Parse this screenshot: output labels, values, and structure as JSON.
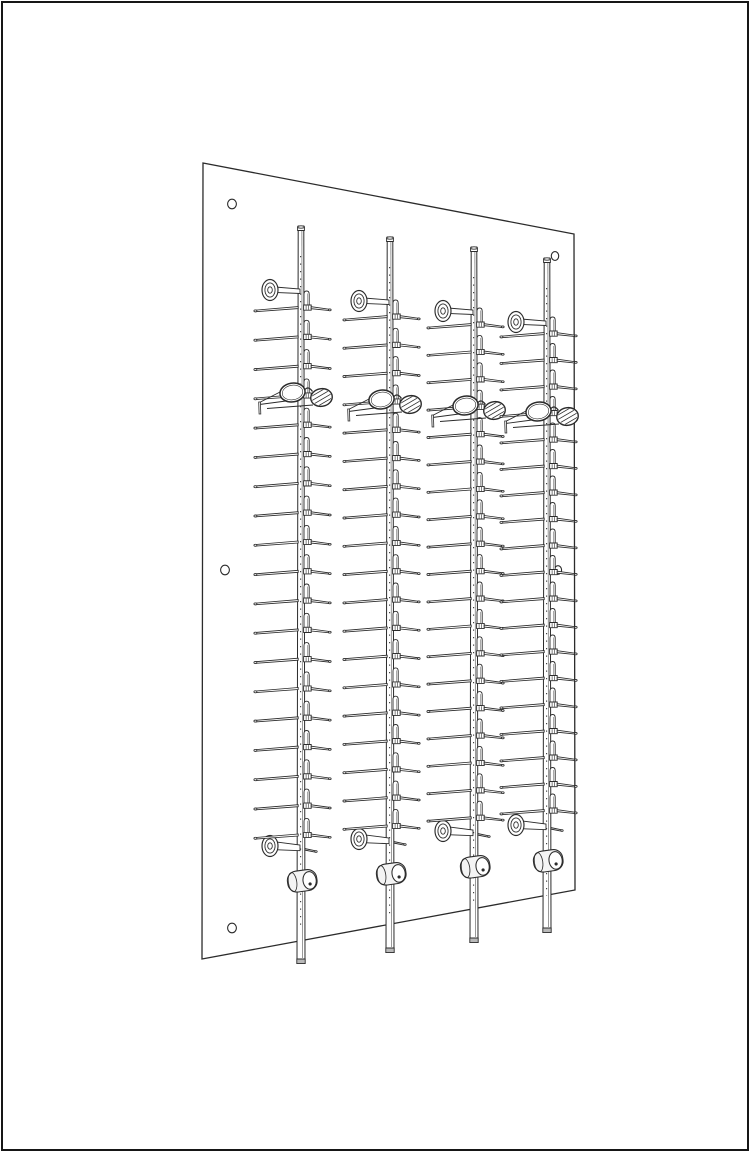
{
  "figure": {
    "title": "Wall-mounted eyewear display rack - technical line illustration, perspective view",
    "style": "black line art on white background, no text",
    "background_color": "#ffffff",
    "line_color": "#2b2b2b",
    "soft_line_color": "#555555",
    "cap_fill": "#b9b9b9",
    "tip_fill": "#e6e6e6",
    "lock_fill": "#f4f4f4",
    "border_color": "#161616",
    "canvas": {
      "width": 750,
      "height": 1152
    }
  },
  "panel": {
    "corners": [
      [
        203,
        163
      ],
      [
        574,
        234
      ],
      [
        575,
        890
      ],
      [
        202,
        959
      ]
    ],
    "mounting_holes": [
      {
        "position": "top-left",
        "cx": 232,
        "cy": 204,
        "rx": 4.4,
        "ry": 4.8
      },
      {
        "position": "top-right",
        "cx": 555,
        "cy": 256,
        "rx": 3.7,
        "ry": 4.4
      },
      {
        "position": "middle-left",
        "cx": 225,
        "cy": 570,
        "rx": 4.4,
        "ry": 4.8
      },
      {
        "position": "middle-right",
        "cx": 558,
        "cy": 570,
        "rx": 3.6,
        "ry": 4.3
      },
      {
        "position": "bottom-left",
        "cx": 232,
        "cy": 928,
        "rx": 4.4,
        "ry": 4.8
      }
    ]
  },
  "rack": {
    "rod_count": 4,
    "rows_per_rod": 19,
    "eyeglasses_per_rod": 1,
    "glasses_row_index": 3,
    "rods": [
      {
        "x": 301,
        "top": 226,
        "bottom": 963,
        "first_row_y": 292,
        "row_spacing": 29.3,
        "top_standoff_y": 290,
        "bottom_standoff_y": 846,
        "lock_y": 881,
        "glasses_y": 395
      },
      {
        "x": 390,
        "top": 237,
        "bottom": 952,
        "first_row_y": 301,
        "row_spacing": 28.3,
        "top_standoff_y": 301,
        "bottom_standoff_y": 839,
        "lock_y": 874,
        "glasses_y": 402
      },
      {
        "x": 474,
        "top": 247,
        "bottom": 942,
        "first_row_y": 309,
        "row_spacing": 27.4,
        "top_standoff_y": 311,
        "bottom_standoff_y": 831,
        "lock_y": 867,
        "glasses_y": 408
      },
      {
        "x": 547,
        "top": 258,
        "bottom": 932,
        "first_row_y": 318,
        "row_spacing": 26.5,
        "top_standoff_y": 322,
        "bottom_standoff_y": 825,
        "lock_y": 861,
        "glasses_y": 414
      }
    ],
    "components": {
      "rod": {
        "half_width_top": 2.8,
        "half_width_bottom": 4.0
      },
      "holder_row": {
        "left_arm_len": 45,
        "left_arm_drop": 3.8,
        "right_arm_len": 18,
        "right_arm_drop": 2.6,
        "clip_height": 13,
        "foot_height": 5.2
      },
      "standoff": {
        "flange_offset_x": -31,
        "flange_rx": 8,
        "flange_ry": 10.5,
        "pin_len": 11
      },
      "lock": {
        "width": 29.5,
        "height": 21,
        "tilt_deg": -8
      },
      "glasses": {
        "left_lens": {
          "dx": -8.5,
          "dy": -2.5,
          "rx": 12.6,
          "ry": 9.4,
          "tilt_deg": -9
        },
        "right_lens": {
          "dx": 20.5,
          "dy": 2.5,
          "rx": 10.8,
          "ry": 8.8,
          "tilt_deg": -9
        },
        "hatched_lens": "right",
        "temple_direction": "left",
        "temple_tip_dx": -41.5,
        "temple_tip_drop": 12
      }
    }
  }
}
